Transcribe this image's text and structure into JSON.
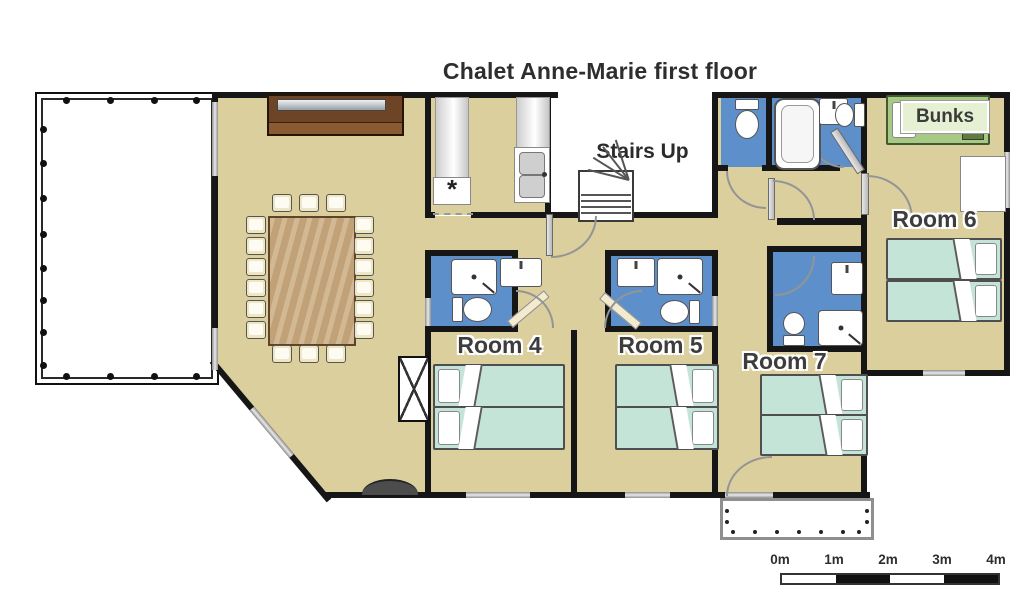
{
  "title": "Chalet Anne-Marie first floor",
  "labels": {
    "stairs_up": "Stairs Up",
    "bunks": "Bunks",
    "room4": "Room 4",
    "room5": "Room 5",
    "room6": "Room 6",
    "room7": "Room 7",
    "freezer_symbol": "*"
  },
  "scale_bar": {
    "labels": [
      "0m",
      "1m",
      "2m",
      "3m",
      "4m"
    ]
  },
  "colors": {
    "floor": "#dbcf9e",
    "wall": "#161616",
    "bathroom": "#5d90ca",
    "bed": "#c5e4d8",
    "bunk": "#a8c886",
    "bunk-label-bg": "#e6f1d4",
    "wood": "#c9a97d",
    "sideboard": "#6d4426",
    "window": "#b5b5b5",
    "text": "#333333"
  }
}
